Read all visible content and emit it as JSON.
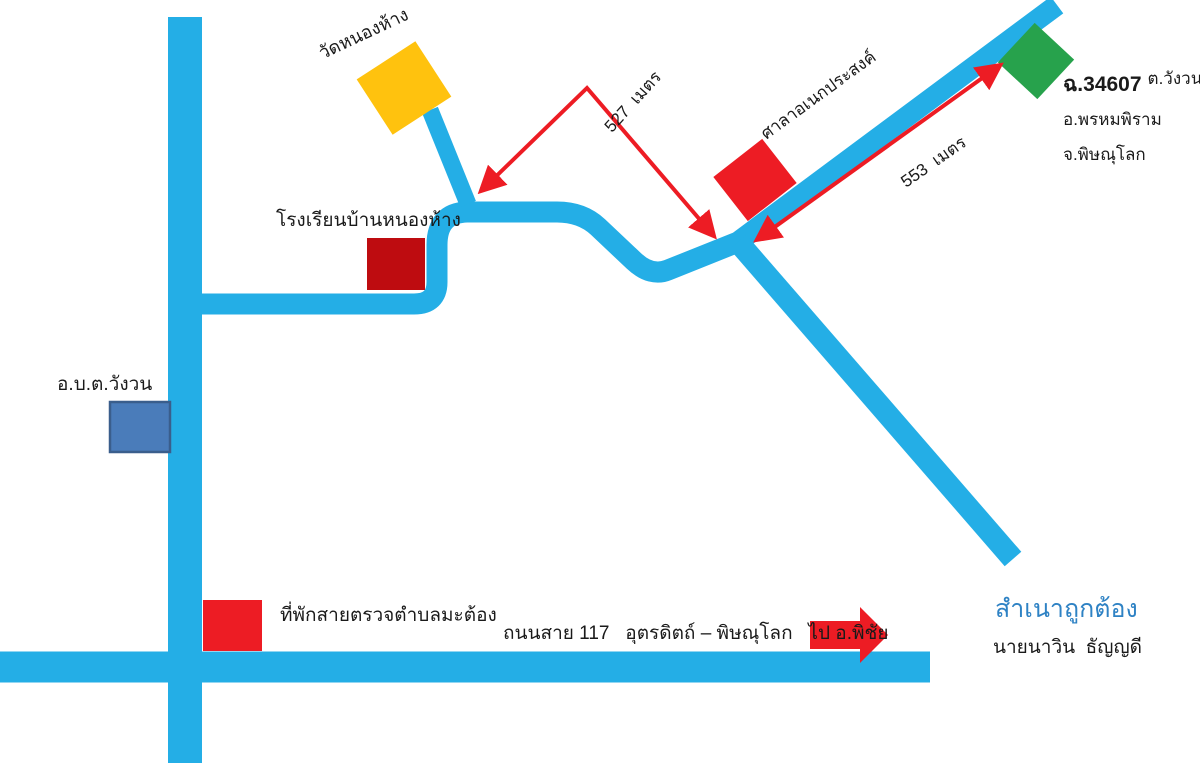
{
  "map": {
    "places": {
      "temple": "วัดหนองห้าง",
      "school": "โรงเรียนบ้านหนองห้าง",
      "pavilion": "ศาลาอเนกประสงค์",
      "sao_office": "อ.บ.ต.วังวน",
      "police_box": "ที่พักสายตรวจตำบลมะต้อง"
    },
    "parcel": {
      "no": "ฉ.34607",
      "subdistrict": "ต.วังวน",
      "district": "อ.พรหมพิราม",
      "province": "จ.พิษณุโลก"
    },
    "distances": {
      "temple_junction": "527  เมตร",
      "junction_parcel": "553  เมตร"
    },
    "highway_label": "ถนนสาย 117   อุตรดิตถ์ – พิษณุโลก   ไป อ.พิชัย",
    "certification": {
      "certified": "สำเนาถูกต้อง",
      "certifier": "นายนาวิน  ธัญญดี"
    },
    "colors": {
      "road": "#24AEE6",
      "temple": "#FFC20E",
      "school": "#BE0C10",
      "red": "#ED1C24",
      "green": "#27A24C",
      "sao_fill": "#4A7CBA",
      "sao_border": "#3A5E8C",
      "certified_text": "#2E82C4"
    }
  }
}
